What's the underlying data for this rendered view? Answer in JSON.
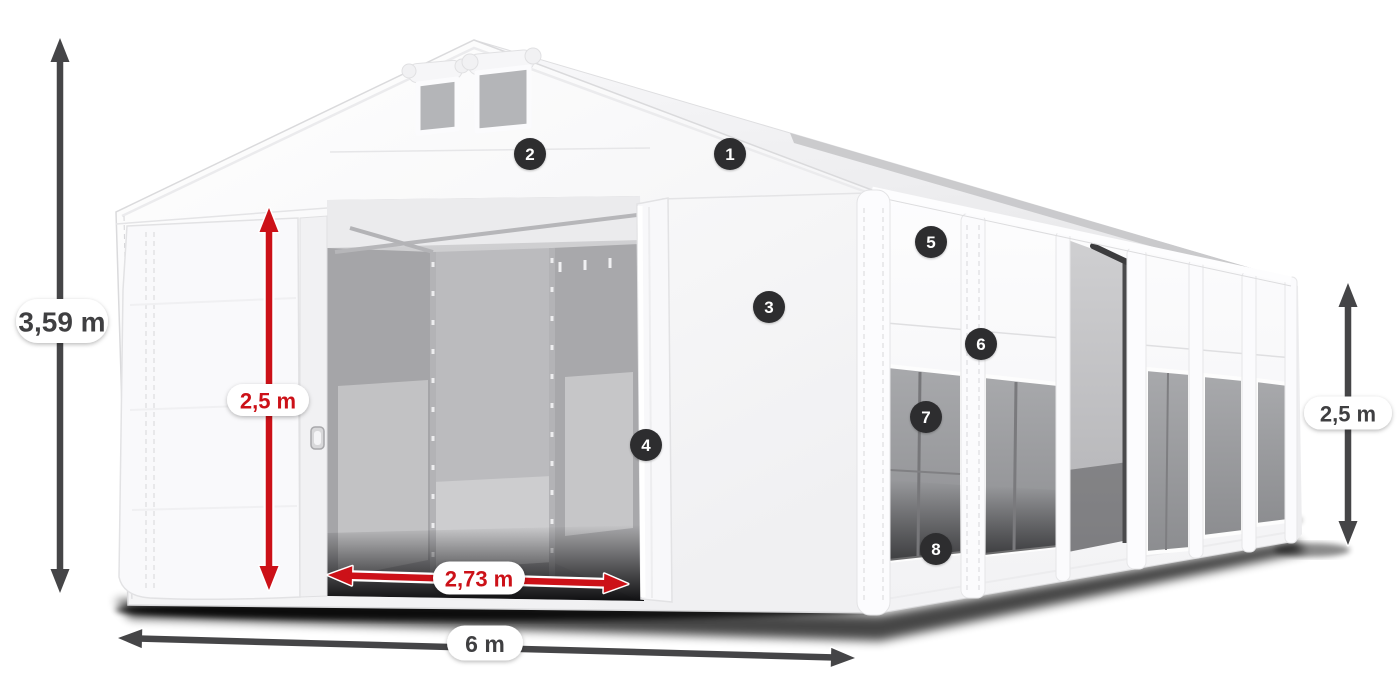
{
  "colors": {
    "red": "#cc1118",
    "dark": "#454547",
    "text_dark": "#3f3f41",
    "badge_bg": "#2d2d2f",
    "badge_text": "#ffffff",
    "pill_bg": "#ffffff"
  },
  "dimensions": [
    {
      "id": "total-height",
      "label": "3,59 m",
      "color": "dark",
      "x1": 60,
      "y1": 38,
      "x2": 60,
      "y2": 593,
      "pill": {
        "x": 62,
        "y": 321,
        "w": 92,
        "h": 44,
        "font": 28
      }
    },
    {
      "id": "entrance-height",
      "label": "2,5 m",
      "color": "red",
      "x1": 269,
      "y1": 208,
      "x2": 269,
      "y2": 590,
      "pill": {
        "x": 268,
        "y": 400,
        "w": 82,
        "h": 32,
        "font": 22
      }
    },
    {
      "id": "entrance-width",
      "label": "2,73 m",
      "color": "red",
      "x1": 328,
      "y1": 575,
      "x2": 628,
      "y2": 584,
      "pill": {
        "x": 479,
        "y": 578,
        "w": 92,
        "h": 33,
        "font": 22
      }
    },
    {
      "id": "total-width",
      "label": "6 m",
      "color": "dark",
      "x1": 118,
      "y1": 638,
      "x2": 855,
      "y2": 658,
      "pill": {
        "x": 485,
        "y": 643,
        "w": 76,
        "h": 35,
        "font": 23
      }
    },
    {
      "id": "side-height",
      "label": "2,5 m",
      "color": "dark",
      "x1": 1348,
      "y1": 283,
      "x2": 1348,
      "y2": 545,
      "pill": {
        "x": 1348,
        "y": 413,
        "w": 88,
        "h": 33,
        "font": 22
      }
    }
  ],
  "markers": [
    {
      "n": "1",
      "x": 730,
      "y": 154
    },
    {
      "n": "2",
      "x": 530,
      "y": 154
    },
    {
      "n": "3",
      "x": 769,
      "y": 307
    },
    {
      "n": "4",
      "x": 646,
      "y": 445
    },
    {
      "n": "5",
      "x": 931,
      "y": 242
    },
    {
      "n": "6",
      "x": 981,
      "y": 344
    },
    {
      "n": "7",
      "x": 926,
      "y": 417
    },
    {
      "n": "8",
      "x": 936,
      "y": 549
    }
  ]
}
